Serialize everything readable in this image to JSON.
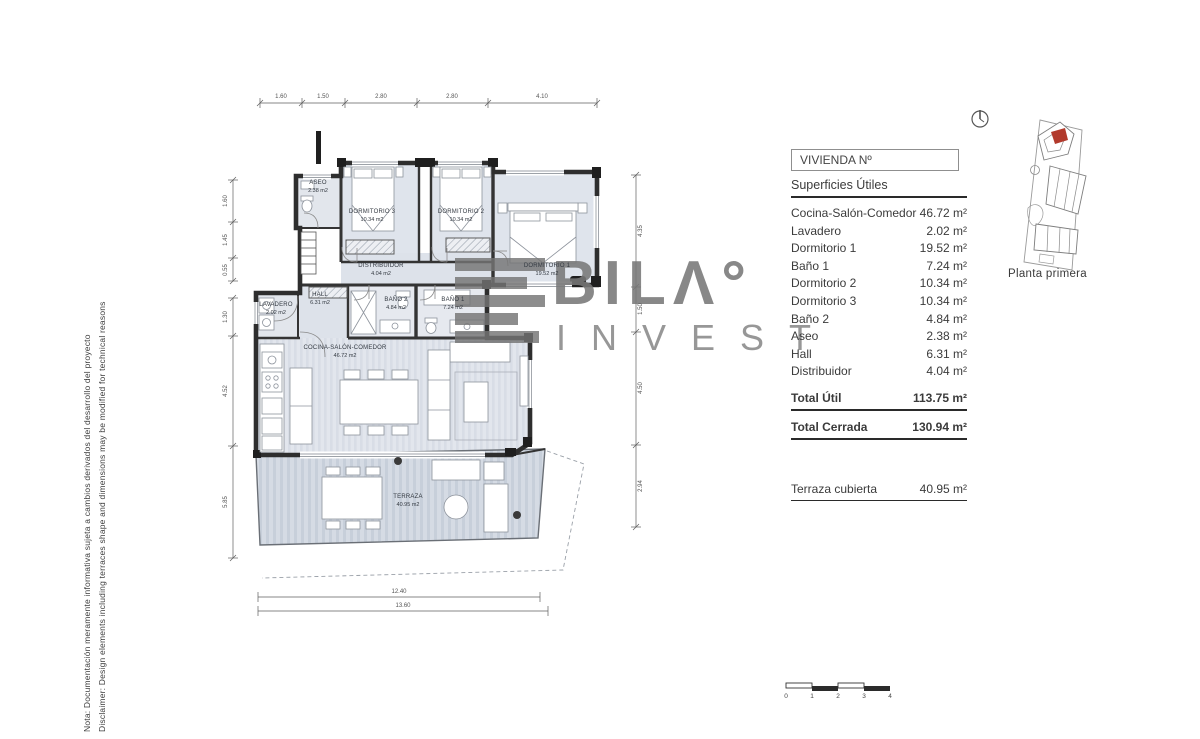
{
  "disclaimer": {
    "line1": "Nota: Documentación meramente informativa sujeta a cambios derivados del desarrollo del proyecto",
    "line2": "Disclaimer: Design elements including terraces shape and dimensions may be modified for technical reasons"
  },
  "brand": {
    "wordmark": "BILΛ°",
    "sub": "INVEST"
  },
  "panel": {
    "title": "VIVIENDA Nº",
    "subtitle": "Superficies Útiles",
    "rows": [
      {
        "label": "Cocina-Salón-Comedor",
        "value": "46.72 m²"
      },
      {
        "label": "Lavadero",
        "value": "2.02 m²"
      },
      {
        "label": "Dormitorio 1",
        "value": "19.52 m²"
      },
      {
        "label": "Baño 1",
        "value": "7.24 m²"
      },
      {
        "label": "Dormitorio 2",
        "value": "10.34 m²"
      },
      {
        "label": "Dormitorio 3",
        "value": "10.34 m²"
      },
      {
        "label": "Baño 2",
        "value": "4.84 m²"
      },
      {
        "label": "Aseo",
        "value": "2.38 m²"
      },
      {
        "label": "Hall",
        "value": "6.31 m²"
      },
      {
        "label": "Distribuidor",
        "value": "4.04 m²"
      }
    ],
    "totals": [
      {
        "label": "Total Útil",
        "value": "113.75 m²"
      },
      {
        "label": "Total Cerrada",
        "value": "130.94 m²"
      }
    ],
    "terrace": {
      "label": "Terraza cubierta",
      "value": "40.95 m²"
    }
  },
  "siteplan": {
    "caption": "Planta primera"
  },
  "plan": {
    "rooms": [
      {
        "name": "ASEO",
        "area": "2.38 m2"
      },
      {
        "name": "DORMITORIO 3",
        "area": "10.34 m2"
      },
      {
        "name": "DORMITORIO 2",
        "area": "10.34 m2"
      },
      {
        "name": "DORMITORIO 1",
        "area": "19.52 m2"
      },
      {
        "name": "DISTRIBUIDOR",
        "area": "4.04 m2"
      },
      {
        "name": "HALL",
        "area": "6.31 m2"
      },
      {
        "name": "BAÑO 2",
        "area": "4.84 m2"
      },
      {
        "name": "BAÑO 1",
        "area": "7.24 m2"
      },
      {
        "name": "LAVADERO",
        "area": "2.02 m2"
      },
      {
        "name": "COCINA-SALÓN-COMEDOR",
        "area": "46.72 m2"
      },
      {
        "name": "TERRAZA",
        "area": "40.95 m2"
      }
    ],
    "dims": {
      "top": [
        "1.60",
        "1.50",
        "2.80",
        "2.80",
        "4.10"
      ],
      "left": [
        "1.60",
        "1.45",
        "0.55",
        "1.30",
        "4.52",
        "5.85"
      ],
      "right": [
        "4.35",
        "1.50",
        "4.50",
        "2.94"
      ],
      "bottom": [
        "12.40",
        "13.60"
      ]
    }
  },
  "scalebar": {
    "labels": [
      "0",
      "1",
      "2",
      "3",
      "4"
    ]
  },
  "icons": {
    "north": "north-compass-icon"
  },
  "colors": {
    "wall": "#2e2e2e",
    "floor": "#dfe4ec",
    "terrace": "#ccd4df",
    "highlight_unit": "#b23a2c",
    "watermark": "#a6a6a6"
  }
}
